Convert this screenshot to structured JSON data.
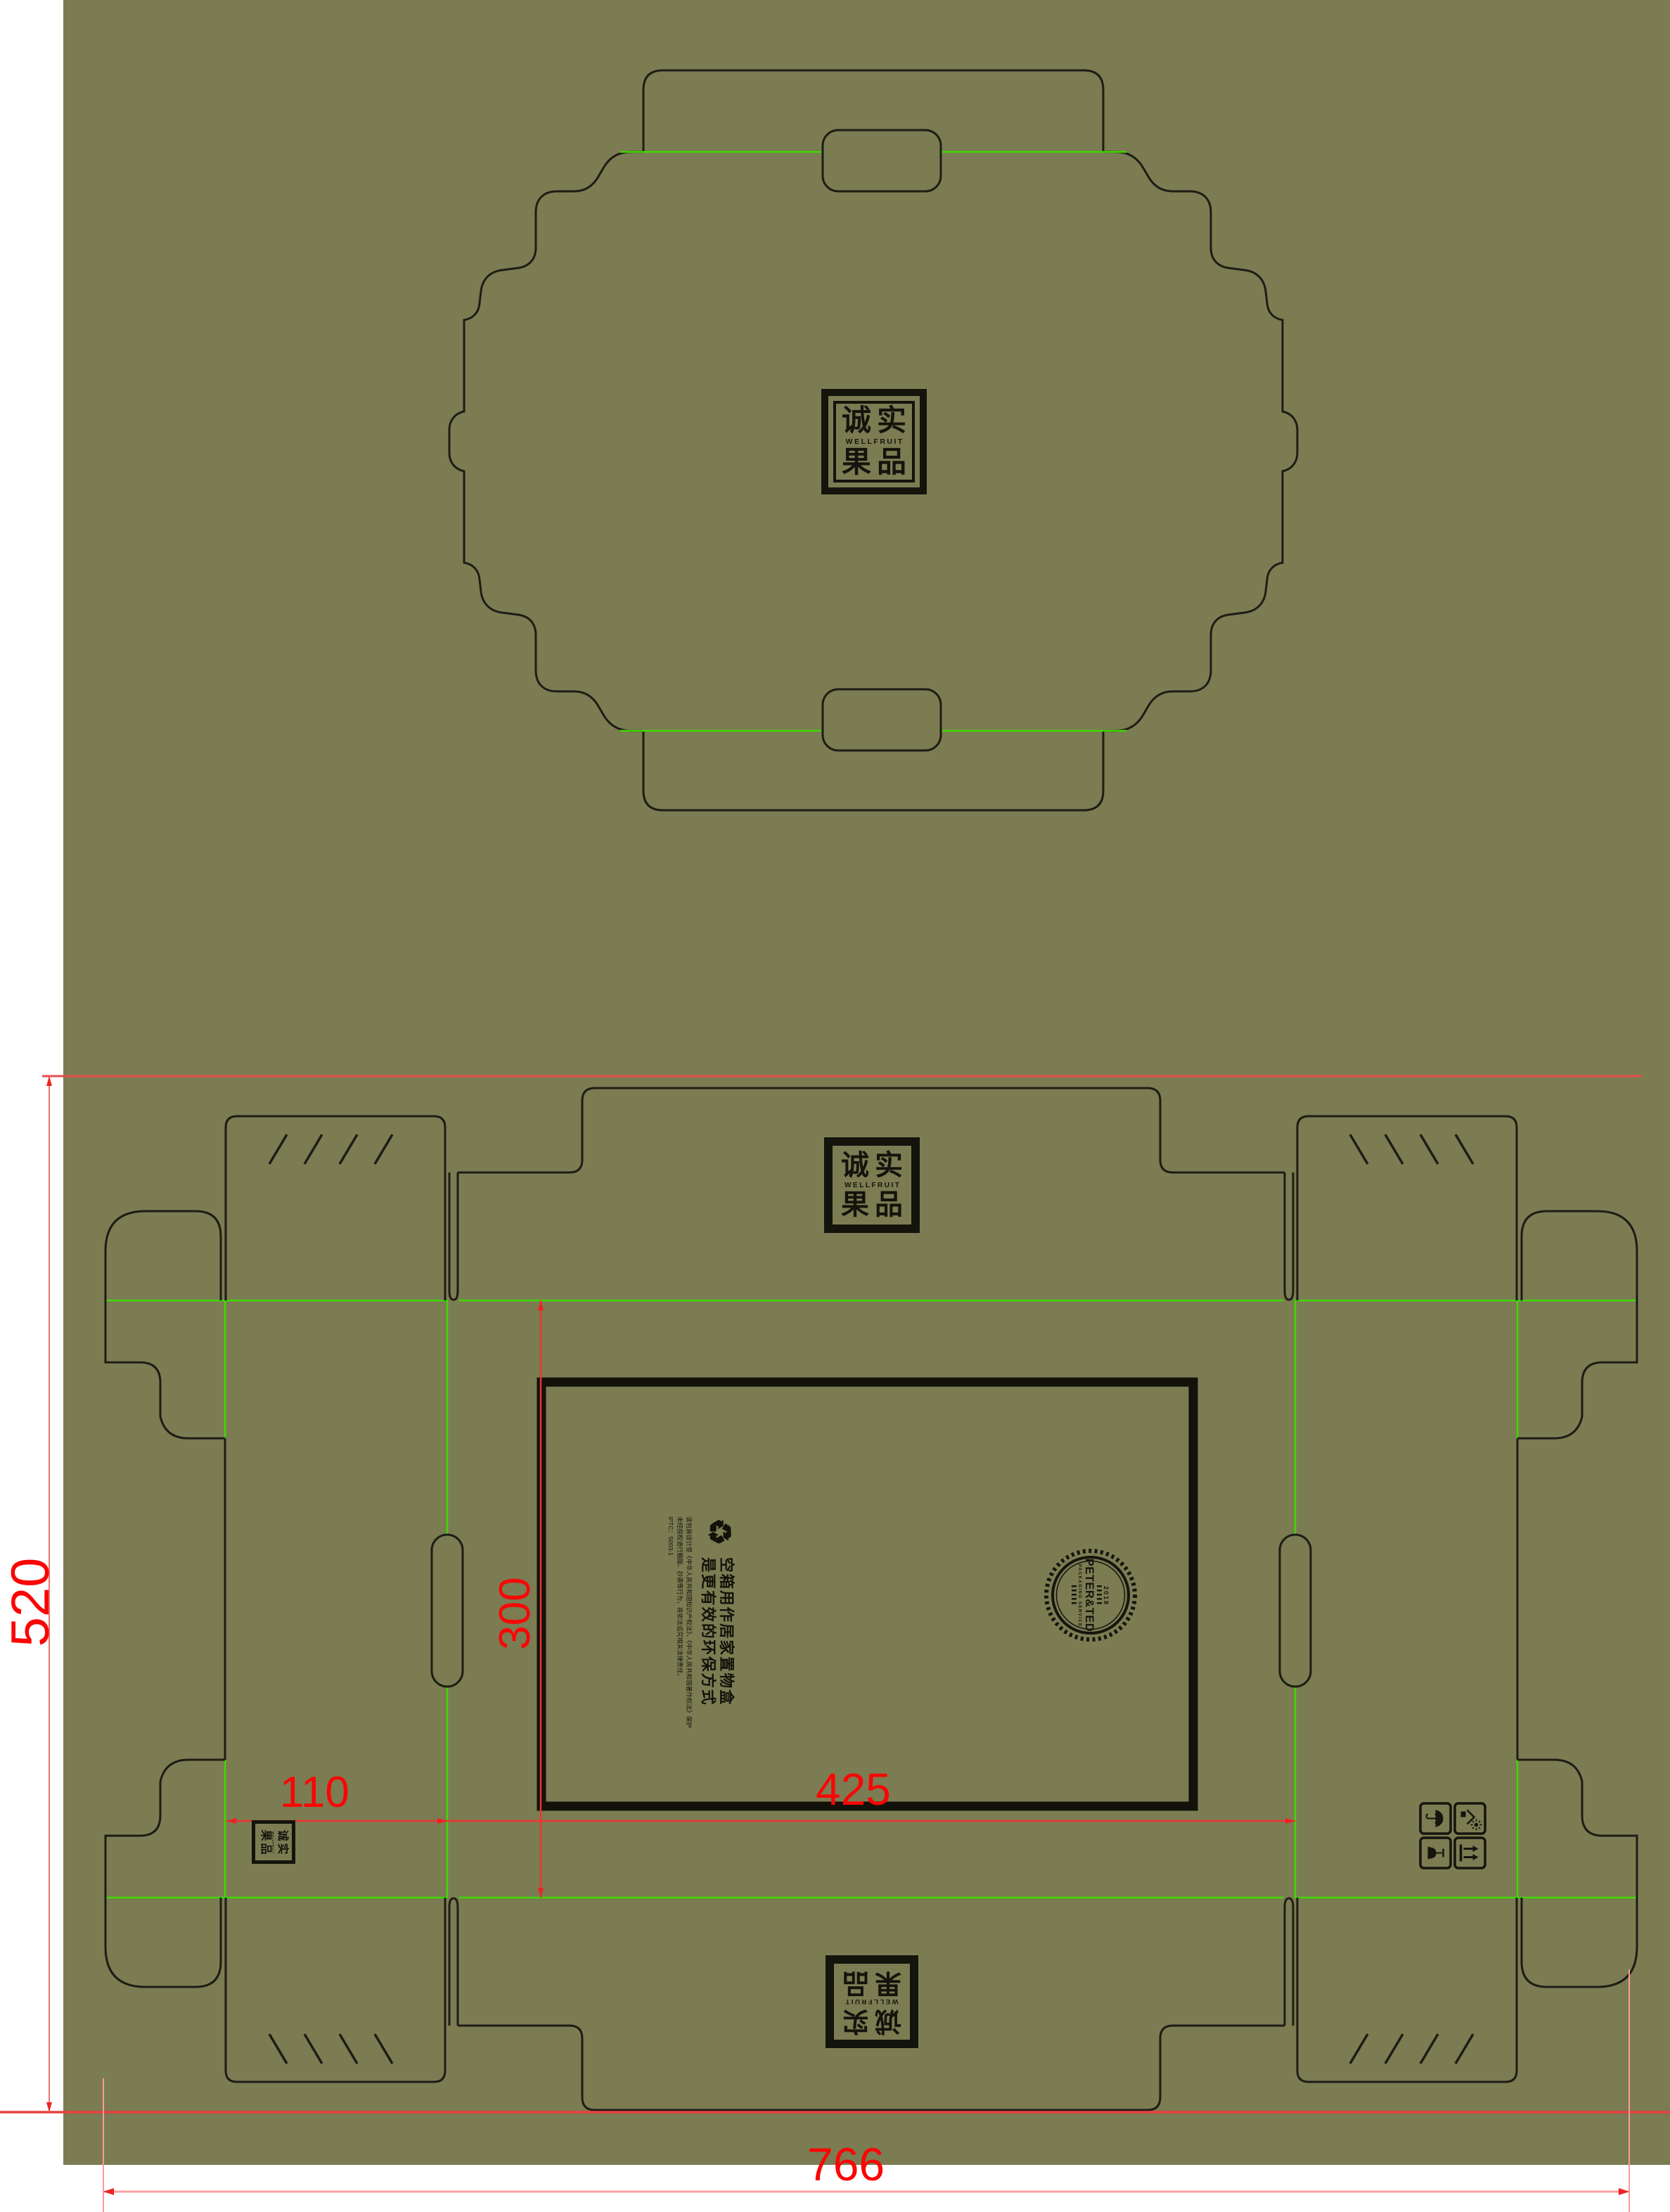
{
  "artboard": {
    "background": "#7b7c52",
    "margin_color": "#ffffff"
  },
  "colors": {
    "cut_line": "#1d1d15",
    "fold_line": "#3fd900",
    "dim_line": "#e84b4b",
    "dim_line_light": "#ffa0a0",
    "dim_text": "#fb0505",
    "print_black": "#12120b"
  },
  "logo": {
    "cn_top": "诚实",
    "en": "WELLFRUIT",
    "cn_bottom": "果品"
  },
  "dimensions": {
    "total_width": "766",
    "total_height": "520",
    "panel_width": "425",
    "panel_height": "300",
    "side_panel_width": "110"
  },
  "print_block": {
    "recycle_icon": "♻",
    "headline_line1": "空箱用作居家置物盒",
    "headline_line2": "是更有效的环保方式",
    "legal_line1": "该包装设计受《中华人民共和国知识产权法》、《中华人民共和国著作权法》保护",
    "legal_line2": "未经授权进行翻版、抄袭等行为，将依法追究相关法律责任。",
    "code": "IPTC：S003-1"
  },
  "stamp": {
    "year": "2018",
    "name": "PETER&TED",
    "subtitle": "PACKAGING SERVICE"
  },
  "handling_icons": [
    {
      "name": "keep-dry"
    },
    {
      "name": "keep-away-from-sunlight"
    },
    {
      "name": "fragile"
    },
    {
      "name": "this-side-up"
    }
  ]
}
